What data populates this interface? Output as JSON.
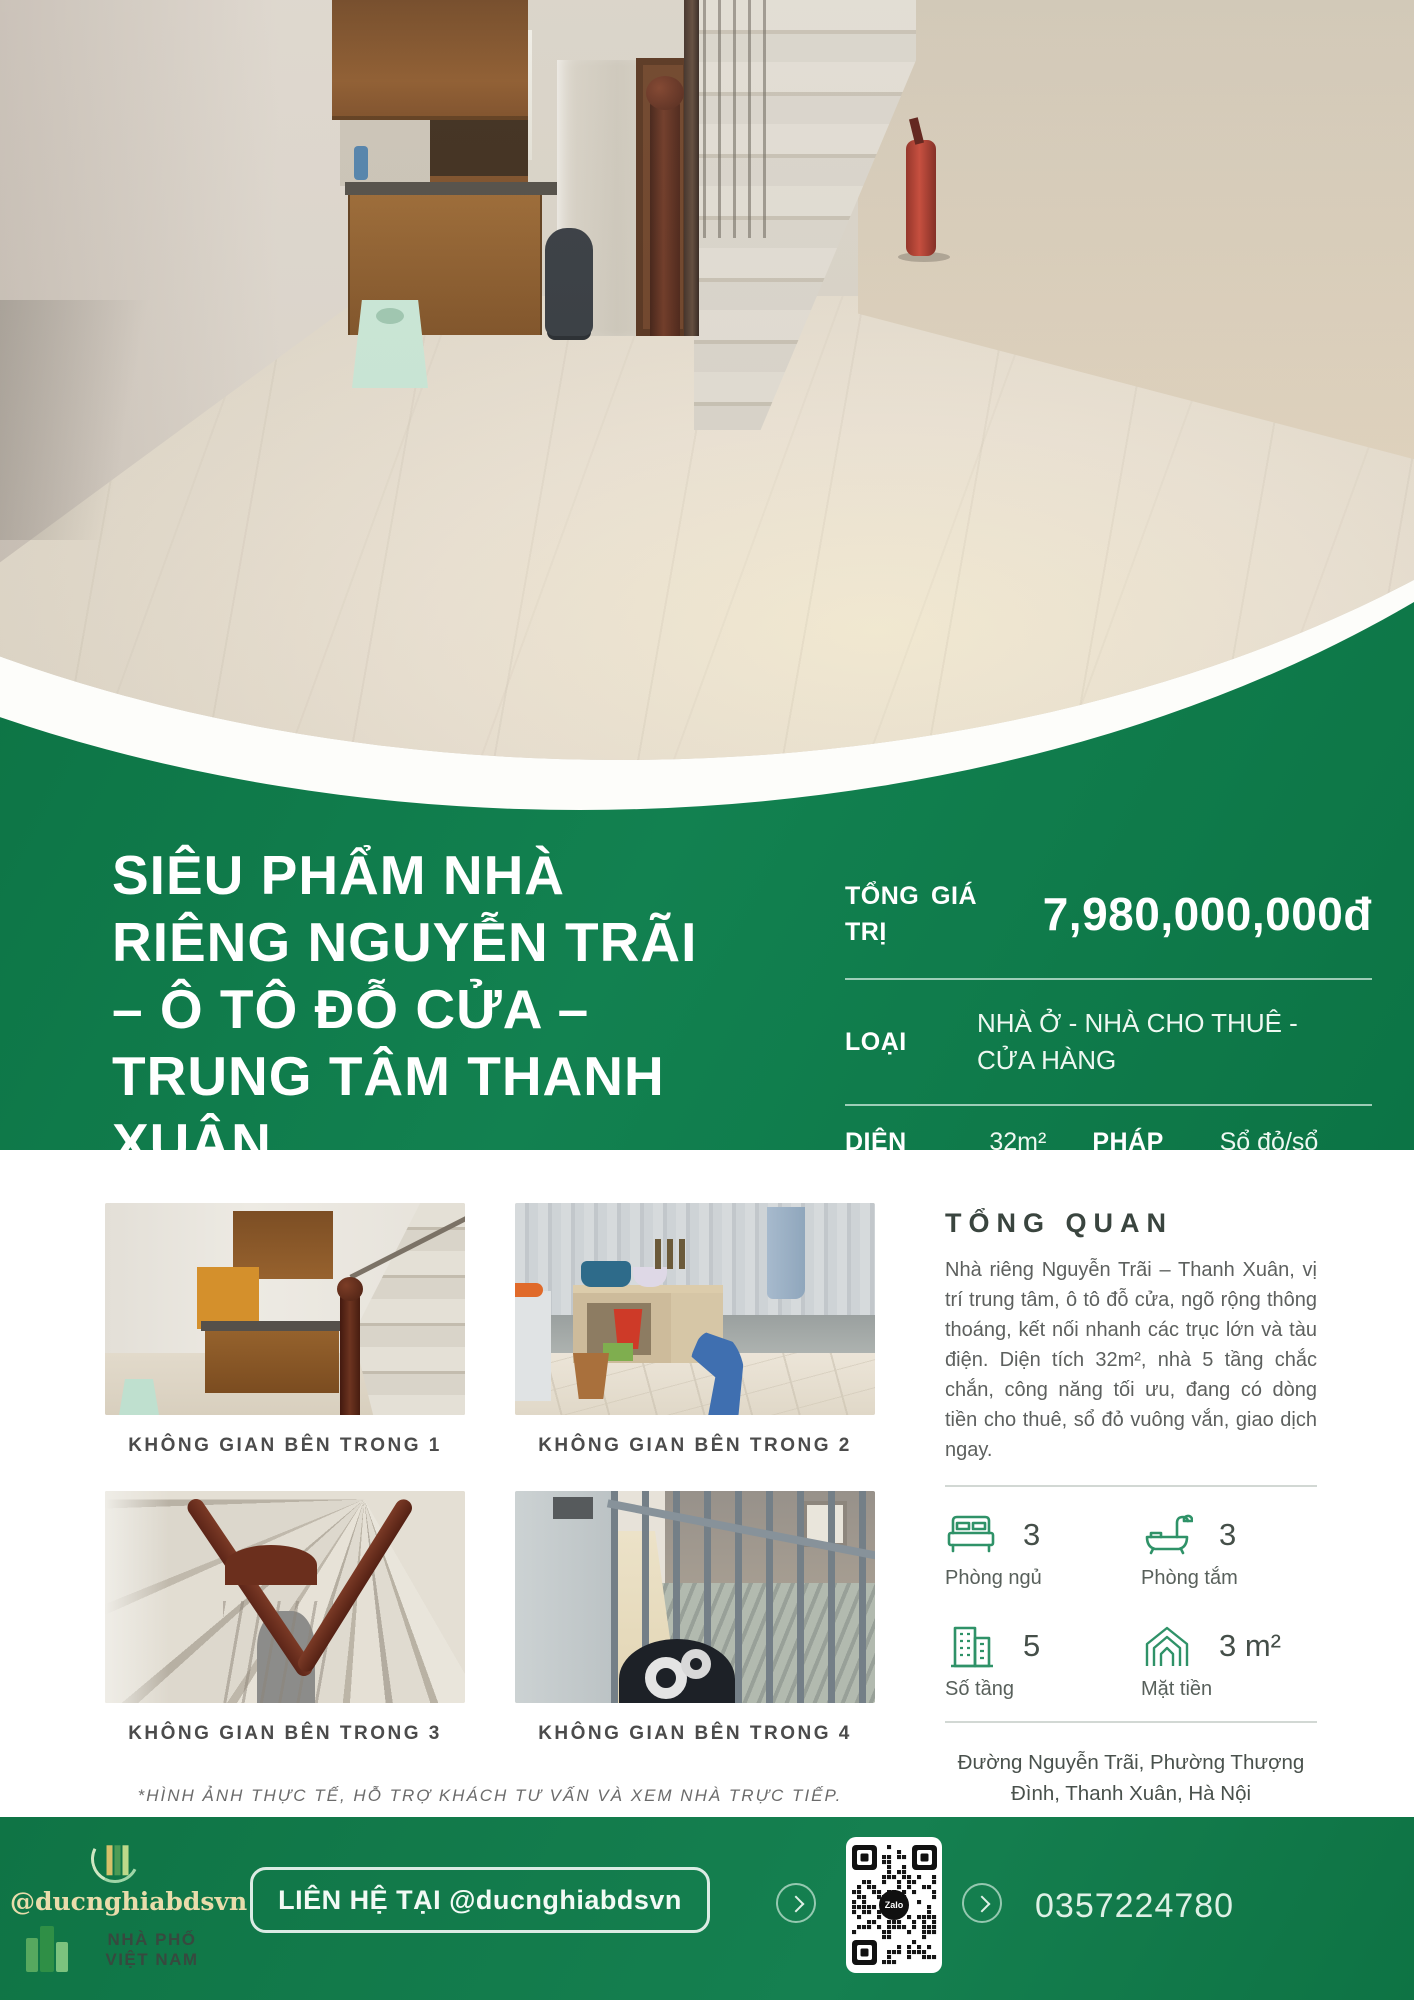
{
  "title_lines": [
    "SIÊU PHẨM NHÀ",
    "RIÊNG NGUYỄN TRÃI",
    "– Ô TÔ ĐỖ CỬA –",
    "TRUNG TÂM THANH",
    "XUÂN"
  ],
  "price": {
    "label": "TỔNG GIÁ TRỊ",
    "value": "7,980,000,000đ"
  },
  "type": {
    "label": "LOẠI",
    "value": "NHÀ Ở - NHÀ CHO THUÊ - CỬA HÀNG"
  },
  "area": {
    "label": "DIỆN TÍCH",
    "value": "32m²"
  },
  "legal": {
    "label": "PHÁP LÝ",
    "value": "Sổ đỏ/sổ hồng"
  },
  "gallery": {
    "captions": [
      "KHÔNG GIAN BÊN TRONG 1",
      "KHÔNG GIAN BÊN TRONG 2",
      "KHÔNG GIAN BÊN TRONG 3",
      "KHÔNG GIAN BÊN TRONG 4"
    ]
  },
  "note": "*HÌNH ẢNH THỰC TẾ, HỖ TRỢ KHÁCH TƯ VẤN VÀ XEM NHÀ TRỰC TIẾP.",
  "overview": {
    "heading": "TỔNG QUAN",
    "description": "Nhà riêng Nguyễn Trãi – Thanh Xuân, vị trí trung tâm, ô tô đỗ cửa, ngõ rộng thông thoáng, kết nối nhanh các trục lớn và tàu điện. Diện tích 32m², nhà 5 tầng chắc chắn, công năng tối ưu, đang có dòng tiền cho thuê, sổ đỏ vuông vắn, giao dịch ngay."
  },
  "stats": [
    {
      "icon": "bed-icon",
      "value": "3",
      "label": "Phòng ngủ"
    },
    {
      "icon": "bathtub-icon",
      "value": "3",
      "label": "Phòng tắm"
    },
    {
      "icon": "building-icon",
      "value": "5",
      "label": "Số tầng"
    },
    {
      "icon": "house-frontage-icon",
      "value": "3 m²",
      "label": "Mặt tiền"
    }
  ],
  "address": "Đường Nguyễn Trãi, Phường Thượng Đình, Thanh Xuân, Hà Nội",
  "footer": {
    "handle": "@ducnghiabdsvn",
    "brand": "NHÀ PHỐ VIỆT NAM",
    "contact_button": "LIÊN HỆ TẠI @ducnghiabdsvn",
    "qr_label": "Zalo",
    "phone": "0357224780"
  },
  "colors": {
    "brand_green": "#0d7747",
    "light_green_text": "#def0e5",
    "accent_gold": "#e9dcab",
    "icon_green": "#2f9268"
  }
}
